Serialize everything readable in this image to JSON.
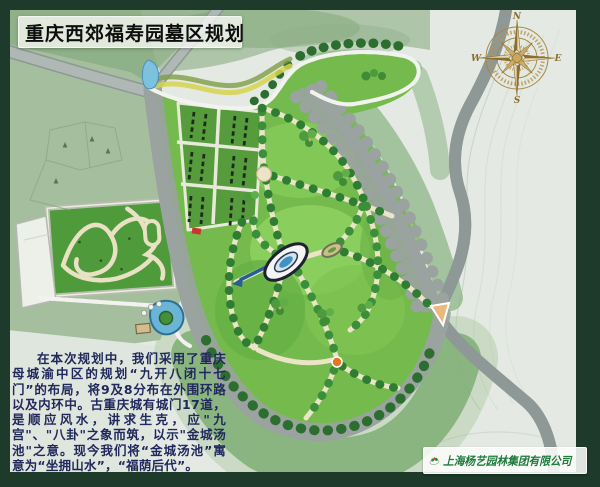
{
  "header": {
    "title": "重庆西郊福寿园墓区规划"
  },
  "compass": {
    "north": "N",
    "south": "S",
    "east": "E",
    "west": "W"
  },
  "description": {
    "text": "在本次规划中，我们采用了重庆母城渝中区的规划“九开八闭十七门”的布局，将9及8分布在外围环路以及内环中。古重庆城有城门17道，是顺应风水，讲求生克，应\"九宫\"、\"八卦\"之象而筑，以示\"金城汤池\"之意。现今我们将“金城汤池”寓意为“坐拥山水”，“福荫后代”。"
  },
  "footer": {
    "company": "上海杨艺园林集团有限公司"
  },
  "legend_colors": {
    "frame_green": "#1d3a2a",
    "boundary_red": "#d23b2f",
    "park_green": "#74ba4d",
    "road_gray": "#aab2ae",
    "water_blue": "#5ab0d8",
    "compass_gold": "#a8893e",
    "description_text": "#20285c",
    "company_green": "#1f7a3c"
  }
}
